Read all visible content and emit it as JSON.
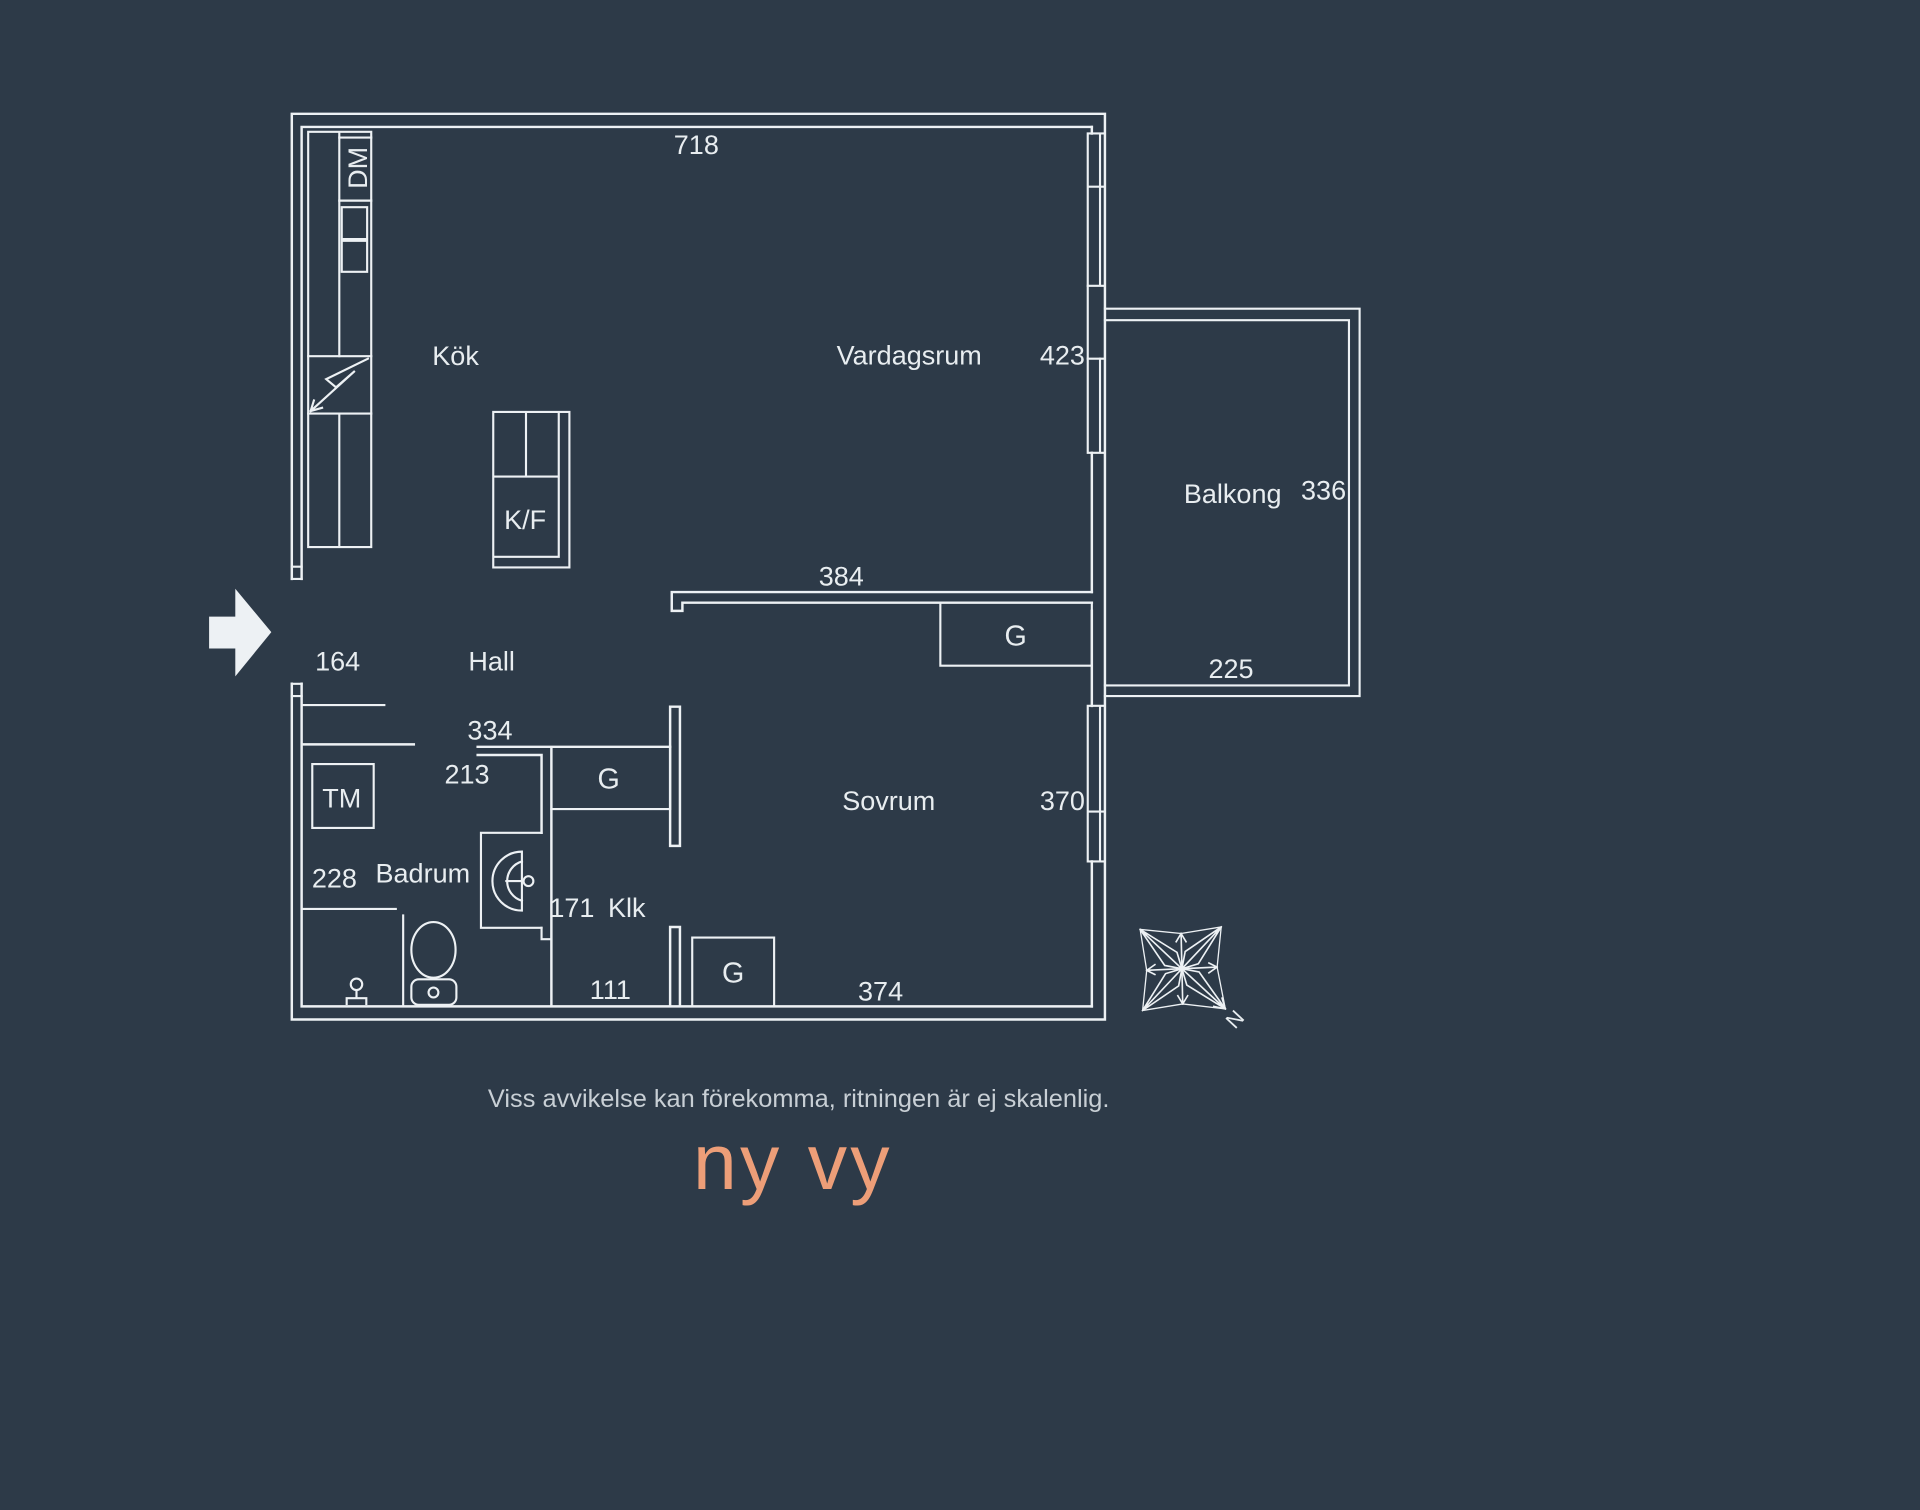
{
  "meta": {
    "kind": "apartment floor plan",
    "language": "sv"
  },
  "colors": {
    "background": "#2D3A48",
    "lines": "#EDF1F4",
    "text": "#E8EDF0",
    "disclaimer": "#C8CFD5",
    "logo": "#ED9E78"
  },
  "plan": {
    "rooms": {
      "kitchen": "Kök",
      "living": "Vardagsrum",
      "hall": "Hall",
      "bathroom": "Badrum",
      "bedroom": "Sovrum",
      "closet": "Klk",
      "balcony": "Balkong"
    },
    "labels": {
      "dishwasher": "DM",
      "washing_machine": "TM",
      "fridge_freezer": "K/F",
      "wardrobe": "G",
      "north": "N"
    },
    "dimensions": {
      "top_wall": "718",
      "living_right": "423",
      "living_bedroom_wall": "384",
      "entrance_niche": "164",
      "hall_width": "334",
      "bathroom_width": "213",
      "bathroom_height": "228",
      "closet_depth": "171",
      "closet_width": "111",
      "bedroom_bottom": "374",
      "bedroom_right": "370",
      "balcony_side": "336",
      "balcony_width": "225"
    }
  },
  "footer": {
    "disclaimer": "Viss avvikelse kan förekomma, ritningen är ej skalenlig.",
    "logo": "ny vy"
  }
}
